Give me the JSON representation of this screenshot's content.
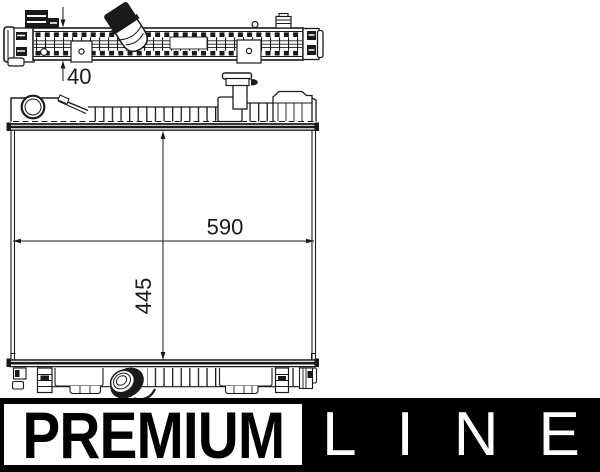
{
  "drawing": {
    "title": "radiator-technical-drawing",
    "dimensions": {
      "depth": "40",
      "width": "590",
      "height": "445"
    }
  },
  "logo": {
    "premium": "PREMIUM",
    "line": "LINE"
  },
  "colors": {
    "ink": "#1a1a1a",
    "logo_black": "#000000",
    "background": "#ffffff"
  }
}
